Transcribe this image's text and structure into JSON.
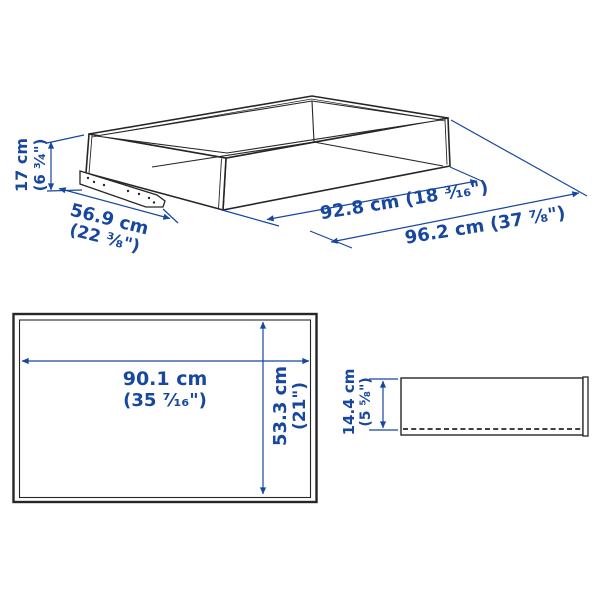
{
  "title": "Drawer dimension diagram",
  "colors": {
    "line": "#262626",
    "dimension": "#17479e",
    "background": "#ffffff"
  },
  "isometric_view": {
    "height": {
      "cm": "17 cm",
      "inch": "(6 ³⁄₄\")"
    },
    "depth": {
      "cm": "56.9 cm",
      "inch": "(22 ³⁄₈\")"
    },
    "inner_width": {
      "text": "92.8 cm (18 ³⁄₁₆\")"
    },
    "outer_width": {
      "text": "96.2 cm (37 ⁷⁄₈\")"
    }
  },
  "top_view": {
    "width": {
      "cm": "90.1 cm",
      "inch": "(35 ⁷⁄₁₆\")"
    },
    "depth": {
      "cm": "53.3 cm",
      "inch": "(21\")"
    }
  },
  "side_view": {
    "height": {
      "cm": "14.4 cm",
      "inch": "(5 ⁵⁄₈\")"
    }
  }
}
